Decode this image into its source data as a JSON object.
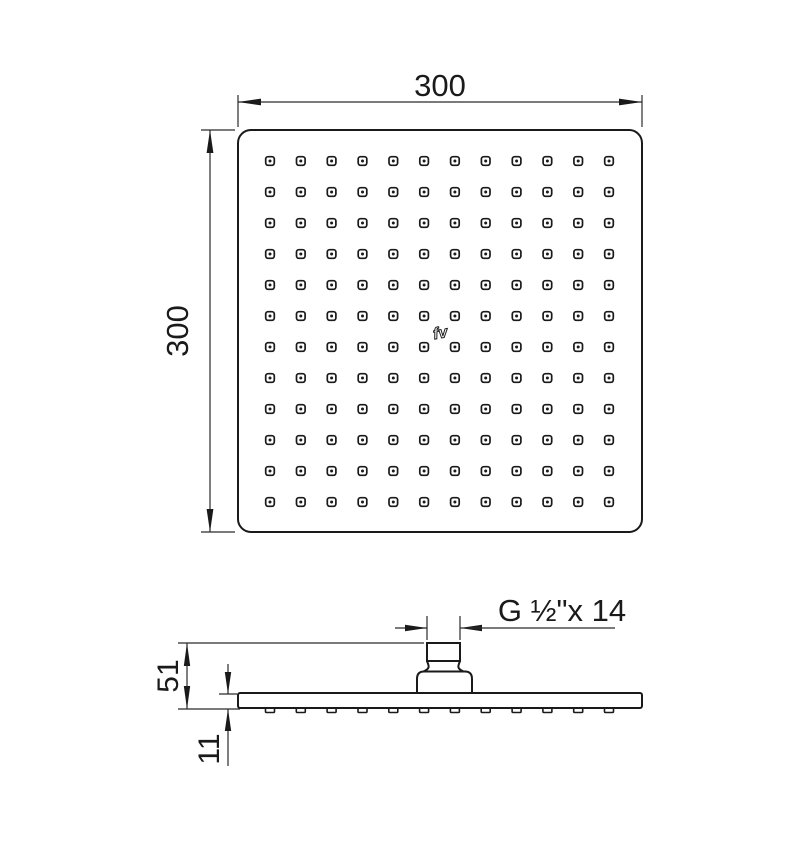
{
  "drawing": {
    "type": "technical-dimension-drawing",
    "subject": "square overhead shower head",
    "line_color": "#1a1a1a",
    "background_color": "#ffffff"
  },
  "labels": {
    "top_width": "300",
    "left_height": "300",
    "overall_height": "51",
    "plate_thickness": "11",
    "thread": "G ½\"x 14",
    "logo": "fv"
  },
  "nozzle_grid": {
    "rows": 12,
    "cols": 12
  }
}
